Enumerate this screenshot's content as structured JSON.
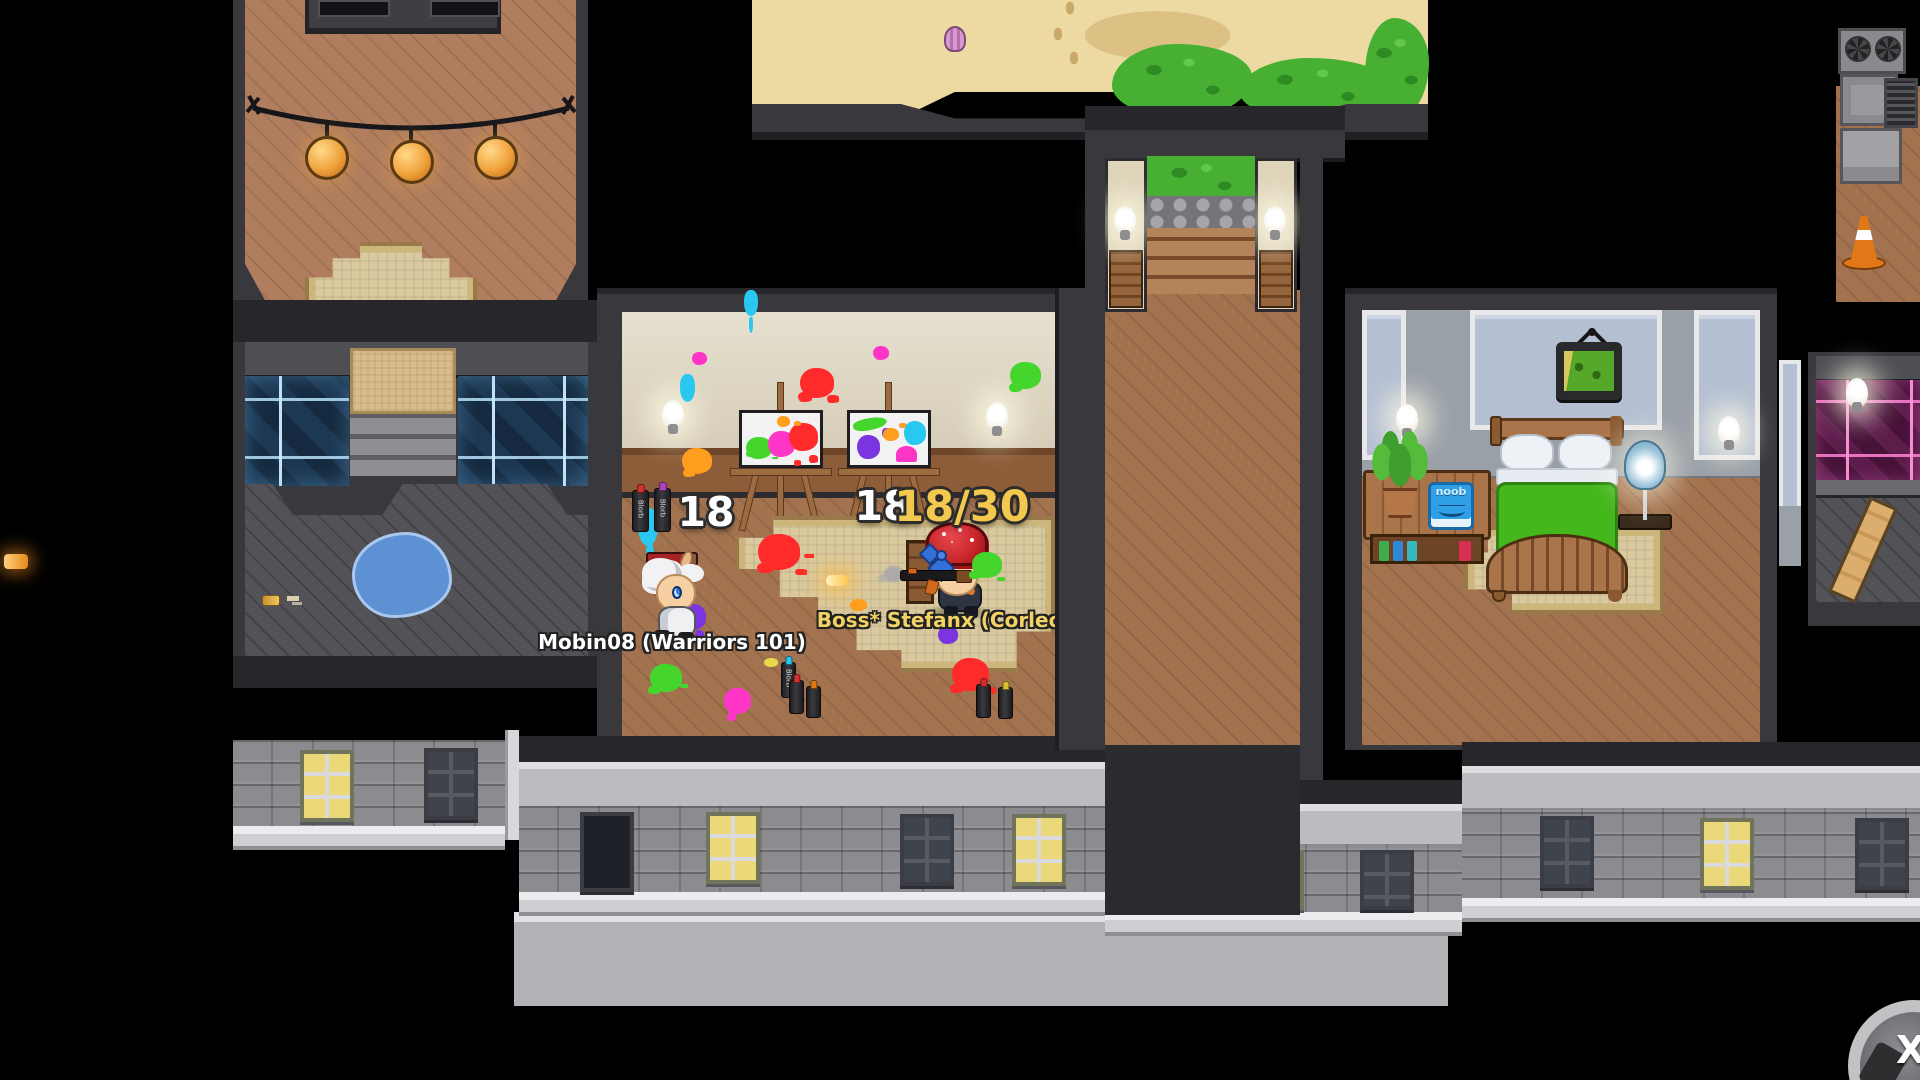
{
  "hud": {
    "easel_left_count": "18",
    "easel_right_count": "18",
    "progress": "18/30",
    "close_label": "X"
  },
  "players": {
    "player1": {
      "name": "Mobin08 (Warriors 101)",
      "name_color": "#ffffff"
    },
    "player2": {
      "name": "Boss* Stefanx (Corleone)",
      "name_color": "#f2d264"
    }
  },
  "items": {
    "spray_can_label": "Blorb",
    "book_label": "noob"
  },
  "colors": {
    "progress_gold": "#f2c84e",
    "counter_white": "#ffffff",
    "neon_blue_lines": "#cdecff",
    "neon_pink_lines": "#ff96dc",
    "blanket_green": "#44b71c",
    "paint_palette": [
      "#ff2a2a",
      "#ff35c8",
      "#44d62c",
      "#ff9d1e",
      "#29c8f0",
      "#7a35e0"
    ]
  }
}
